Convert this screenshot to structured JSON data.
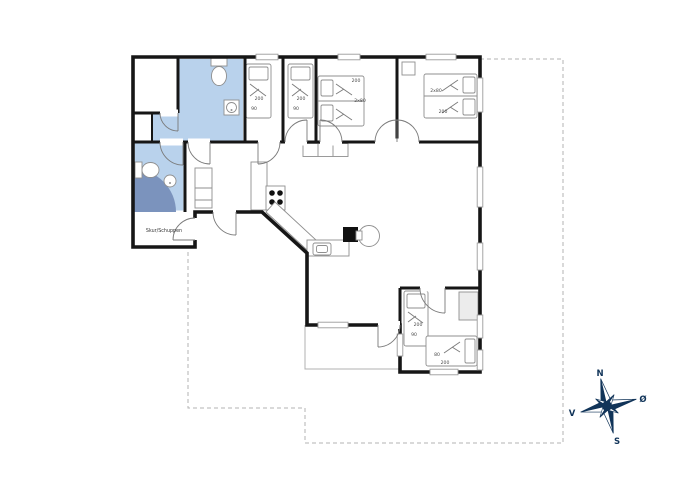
{
  "plan": {
    "shed_label": "Skur/Schuppen",
    "beds": [
      {
        "name": "bedroom-1-bed",
        "length": "200",
        "width": "90"
      },
      {
        "name": "bedroom-2-bed",
        "length": "200",
        "width": "90"
      },
      {
        "name": "bedroom-3-double-bed",
        "length": "200",
        "width": "2x80"
      },
      {
        "name": "bedroom-4-double-bed",
        "length": "200",
        "width": "2x80"
      },
      {
        "name": "annex-bed-vertical",
        "length": "200",
        "width": "90"
      },
      {
        "name": "annex-bed-horizontal",
        "length": "200",
        "width": "80"
      }
    ],
    "compass": {
      "north": "N",
      "east": "Ø",
      "south": "S",
      "west": "V"
    },
    "colors": {
      "bathroom_fill": "#b9d2ec",
      "shower_fill": "#7b93bd",
      "wall": "#161616",
      "compass_navy": "#113459",
      "dashed_boundary": "#b3b3b3"
    }
  }
}
